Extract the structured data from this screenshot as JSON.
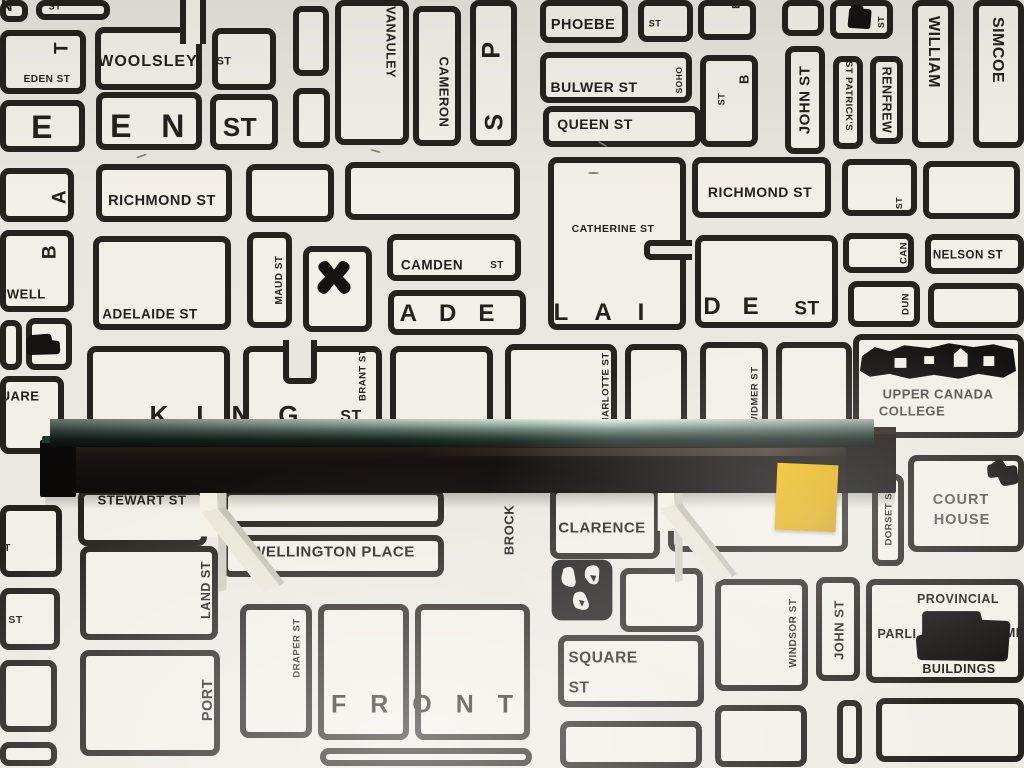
{
  "scene": {
    "wall_color": "#e9e6df",
    "map_ink": "#26221e",
    "map_paper": "#f2efe7"
  },
  "shelf": {
    "glass_color": "#5c7a6c",
    "board_color": "#14100d",
    "bracket_color": "#eee9dd",
    "sticky_note_color": "#e7b214"
  },
  "map": {
    "blocks": [
      [
        0,
        0,
        28,
        22
      ],
      [
        36,
        0,
        74,
        20
      ],
      [
        293,
        6,
        36,
        70
      ],
      [
        293,
        88,
        37,
        60
      ],
      [
        0,
        30,
        86,
        64
      ],
      [
        0,
        100,
        85,
        52
      ],
      [
        95,
        27,
        107,
        63
      ],
      [
        212,
        28,
        64,
        62
      ],
      [
        96,
        92,
        106,
        58
      ],
      [
        210,
        94,
        68,
        56
      ],
      [
        335,
        0,
        74,
        145
      ],
      [
        413,
        6,
        48,
        140
      ],
      [
        470,
        0,
        47,
        146
      ],
      [
        540,
        0,
        88,
        43
      ],
      [
        638,
        0,
        55,
        42
      ],
      [
        540,
        52,
        152,
        51
      ],
      [
        543,
        106,
        158,
        41
      ],
      [
        700,
        55,
        58,
        92
      ],
      [
        698,
        0,
        58,
        40
      ],
      [
        785,
        46,
        40,
        108
      ],
      [
        782,
        0,
        42,
        36
      ],
      [
        830,
        0,
        63,
        39
      ],
      [
        833,
        56,
        30,
        93
      ],
      [
        870,
        56,
        33,
        88
      ],
      [
        912,
        0,
        42,
        148
      ],
      [
        973,
        0,
        51,
        148
      ],
      [
        0,
        168,
        74,
        54
      ],
      [
        0,
        230,
        74,
        82
      ],
      [
        0,
        320,
        22,
        50
      ],
      [
        26,
        318,
        46,
        52
      ],
      [
        0,
        376,
        64,
        78
      ],
      [
        96,
        164,
        136,
        58
      ],
      [
        246,
        164,
        88,
        58
      ],
      [
        345,
        162,
        175,
        58
      ],
      [
        93,
        236,
        138,
        94
      ],
      [
        247,
        232,
        45,
        96
      ],
      [
        303,
        246,
        69,
        86
      ],
      [
        387,
        234,
        134,
        47
      ],
      [
        388,
        290,
        138,
        45
      ],
      [
        548,
        157,
        138,
        173
      ],
      [
        692,
        157,
        139,
        61
      ],
      [
        695,
        235,
        143,
        93
      ],
      [
        842,
        159,
        75,
        57
      ],
      [
        843,
        233,
        71,
        40
      ],
      [
        848,
        281,
        72,
        46
      ],
      [
        923,
        161,
        97,
        58
      ],
      [
        925,
        234,
        99,
        40
      ],
      [
        928,
        283,
        96,
        45
      ],
      [
        87,
        346,
        143,
        97
      ],
      [
        243,
        346,
        139,
        96
      ],
      [
        390,
        346,
        103,
        96
      ],
      [
        505,
        344,
        112,
        94
      ],
      [
        625,
        344,
        62,
        92
      ],
      [
        700,
        342,
        68,
        94
      ],
      [
        776,
        342,
        76,
        94
      ],
      [
        853,
        334,
        171,
        104
      ],
      [
        78,
        489,
        129,
        57
      ],
      [
        222,
        489,
        222,
        38
      ],
      [
        222,
        535,
        222,
        42
      ],
      [
        550,
        487,
        110,
        72
      ],
      [
        668,
        480,
        180,
        72
      ],
      [
        872,
        474,
        32,
        92
      ],
      [
        908,
        455,
        116,
        97
      ],
      [
        620,
        568,
        83,
        64
      ],
      [
        558,
        635,
        146,
        72
      ],
      [
        560,
        721,
        142,
        47
      ],
      [
        715,
        579,
        93,
        112
      ],
      [
        816,
        577,
        44,
        104
      ],
      [
        866,
        579,
        158,
        104
      ],
      [
        837,
        700,
        25,
        64
      ],
      [
        876,
        698,
        148,
        64
      ],
      [
        80,
        546,
        138,
        94
      ],
      [
        80,
        650,
        140,
        106
      ],
      [
        240,
        604,
        72,
        134
      ],
      [
        318,
        604,
        91,
        136
      ],
      [
        415,
        604,
        115,
        136
      ],
      [
        320,
        748,
        212,
        18
      ],
      [
        0,
        505,
        62,
        72
      ],
      [
        0,
        588,
        60,
        62
      ],
      [
        0,
        660,
        57,
        72
      ],
      [
        0,
        742,
        57,
        24
      ],
      [
        715,
        705,
        92,
        62
      ]
    ],
    "cuts": [
      {
        "x": 283,
        "y": 340,
        "w": 34,
        "h": 44,
        "open": "top"
      },
      {
        "x": 180,
        "y": 0,
        "w": 26,
        "h": 44,
        "open": "vert"
      },
      {
        "x": 644,
        "y": 240,
        "w": 48,
        "h": 20,
        "open": "right"
      }
    ],
    "labels": [
      {
        "t": "N",
        "x": 7,
        "y": 7,
        "s": 16,
        "r": "h"
      },
      {
        "t": "ST",
        "x": 55,
        "y": 7,
        "s": 9,
        "r": "h"
      },
      {
        "t": "T",
        "x": 62,
        "y": 48,
        "s": 19,
        "r": "up"
      },
      {
        "t": "EDEN ST",
        "x": 47,
        "y": 80,
        "s": 10,
        "r": "h"
      },
      {
        "t": "WOOLSLEY",
        "x": 148,
        "y": 62,
        "s": 16,
        "r": "h",
        "ls": 1
      },
      {
        "t": "ST",
        "x": 224,
        "y": 62,
        "s": 11,
        "r": "h"
      },
      {
        "t": "E",
        "x": 42,
        "y": 127,
        "s": 32,
        "r": "h"
      },
      {
        "t": "E",
        "x": 121,
        "y": 126,
        "s": 32,
        "r": "h"
      },
      {
        "t": "N",
        "x": 173,
        "y": 126,
        "s": 32,
        "r": "h"
      },
      {
        "t": "ST",
        "x": 240,
        "y": 127,
        "s": 26,
        "r": "h"
      },
      {
        "t": "A",
        "x": 60,
        "y": 197,
        "s": 19,
        "r": "up"
      },
      {
        "t": "B",
        "x": 50,
        "y": 252,
        "s": 19,
        "r": "up"
      },
      {
        "t": "OWELL",
        "x": 21,
        "y": 294,
        "s": 13,
        "r": "h"
      },
      {
        "t": "UARE",
        "x": 20,
        "y": 396,
        "s": 13,
        "r": "h"
      },
      {
        "t": "VANAULEY",
        "x": 390,
        "y": 42,
        "s": 12.5,
        "r": "down"
      },
      {
        "t": "CAMERON",
        "x": 444,
        "y": 92,
        "s": 13,
        "r": "down"
      },
      {
        "t": "P",
        "x": 492,
        "y": 50,
        "s": 25,
        "r": "up"
      },
      {
        "t": "S",
        "x": 495,
        "y": 122,
        "s": 25,
        "r": "up"
      },
      {
        "t": "PHOEBE",
        "x": 583,
        "y": 25,
        "s": 14.5,
        "r": "h"
      },
      {
        "t": "ST",
        "x": 655,
        "y": 24,
        "s": 9,
        "r": "h"
      },
      {
        "t": "BULWER ST",
        "x": 594,
        "y": 87,
        "s": 14,
        "r": "h"
      },
      {
        "t": "SOHO",
        "x": 679,
        "y": 80,
        "s": 8.5,
        "r": "up"
      },
      {
        "t": "QUEEN ST",
        "x": 595,
        "y": 124,
        "s": 14,
        "r": "h"
      },
      {
        "t": "ST",
        "x": 722,
        "y": 99,
        "s": 9,
        "r": "up"
      },
      {
        "t": "B",
        "x": 744,
        "y": 79,
        "s": 13,
        "r": "up"
      },
      {
        "t": "E",
        "x": 737,
        "y": 5,
        "s": 11,
        "r": "up"
      },
      {
        "t": "JOHN ST",
        "x": 805,
        "y": 100,
        "s": 15,
        "r": "up"
      },
      {
        "t": "ST PATRICK'S",
        "x": 848,
        "y": 96,
        "s": 9.5,
        "r": "down"
      },
      {
        "t": "RENFREW",
        "x": 886,
        "y": 100,
        "s": 12.5,
        "r": "down"
      },
      {
        "t": "ST",
        "x": 881,
        "y": 22,
        "s": 8.5,
        "r": "up"
      },
      {
        "t": "WILLIAM",
        "x": 933,
        "y": 52,
        "s": 16,
        "r": "down"
      },
      {
        "t": "SIMCOE",
        "x": 997,
        "y": 50,
        "s": 16,
        "r": "down"
      },
      {
        "t": "RICHMOND ST",
        "x": 162,
        "y": 201,
        "s": 14.5,
        "r": "h"
      },
      {
        "t": "ADELAIDE ST",
        "x": 150,
        "y": 314,
        "s": 13.5,
        "r": "h"
      },
      {
        "t": "MAUD ST",
        "x": 280,
        "y": 280,
        "s": 10,
        "r": "up"
      },
      {
        "t": "CAMDEN",
        "x": 432,
        "y": 265,
        "s": 13.5,
        "r": "h"
      },
      {
        "t": "ST",
        "x": 497,
        "y": 266,
        "s": 10,
        "r": "h"
      },
      {
        "t": "ADE",
        "x": 458,
        "y": 314,
        "s": 24,
        "r": "h",
        "ls": 22
      },
      {
        "t": "CATHERINE ST",
        "x": 613,
        "y": 229,
        "s": 10.5,
        "r": "h"
      },
      {
        "t": "LAI",
        "x": 612,
        "y": 313,
        "s": 24,
        "r": "h",
        "ls": 26
      },
      {
        "t": "RICHMOND ST",
        "x": 760,
        "y": 192,
        "s": 14,
        "r": "h"
      },
      {
        "t": "ST",
        "x": 899,
        "y": 203,
        "s": 8.5,
        "r": "up"
      },
      {
        "t": "CAN",
        "x": 904,
        "y": 253,
        "s": 9.5,
        "r": "up"
      },
      {
        "t": "DUN",
        "x": 906,
        "y": 304,
        "s": 9.5,
        "r": "up"
      },
      {
        "t": "NELSON ST",
        "x": 968,
        "y": 256,
        "s": 11.5,
        "r": "h"
      },
      {
        "t": "DE",
        "x": 742,
        "y": 307,
        "s": 24,
        "r": "h",
        "ls": 22
      },
      {
        "t": "ST",
        "x": 807,
        "y": 309,
        "s": 19,
        "r": "h"
      },
      {
        "t": "KING",
        "x": 238,
        "y": 415,
        "s": 26,
        "r": "h",
        "ls": 28
      },
      {
        "t": "ST",
        "x": 351,
        "y": 417,
        "s": 16,
        "r": "h"
      },
      {
        "t": "BRANT ST",
        "x": 363,
        "y": 375,
        "s": 9.5,
        "r": "up"
      },
      {
        "t": "CHARLOTTE ST",
        "x": 606,
        "y": 392,
        "s": 9.5,
        "r": "up"
      },
      {
        "t": "WIDMER ST",
        "x": 755,
        "y": 396,
        "s": 9.5,
        "r": "up"
      },
      {
        "t": "UPPER CANADA",
        "x": 938,
        "y": 394,
        "s": 13,
        "r": "h",
        "c": "gray"
      },
      {
        "t": "COLLEGE",
        "x": 912,
        "y": 411,
        "s": 13,
        "r": "h",
        "c": "gray"
      },
      {
        "t": "STEWART ST",
        "x": 142,
        "y": 500,
        "s": 13,
        "r": "h"
      },
      {
        "t": "MERCER ST",
        "x": 748,
        "y": 489,
        "s": 10,
        "r": "h"
      },
      {
        "t": "DORSET ST",
        "x": 889,
        "y": 516,
        "s": 9.5,
        "r": "up"
      },
      {
        "t": "COURT",
        "x": 961,
        "y": 500,
        "s": 14.5,
        "r": "h",
        "c": "gray",
        "ls": 1
      },
      {
        "t": "HOUSE",
        "x": 962,
        "y": 520,
        "s": 14.5,
        "r": "h",
        "c": "gray",
        "ls": 1
      },
      {
        "t": "CLARENCE",
        "x": 602,
        "y": 528,
        "s": 15,
        "r": "h"
      },
      {
        "t": "WELLINGTON PLACE",
        "x": 333,
        "y": 552,
        "s": 15,
        "r": "h"
      },
      {
        "t": "BROCK",
        "x": 509,
        "y": 530,
        "s": 13,
        "r": "up"
      },
      {
        "t": "ST",
        "x": 4,
        "y": 549,
        "s": 10,
        "r": "h"
      },
      {
        "t": "A ST",
        "x": 10,
        "y": 620,
        "s": 10.5,
        "r": "h"
      },
      {
        "t": "LAND ST",
        "x": 206,
        "y": 590,
        "s": 12.5,
        "r": "up"
      },
      {
        "t": "PORT",
        "x": 208,
        "y": 700,
        "s": 14.5,
        "r": "up"
      },
      {
        "t": "DRAPER ST",
        "x": 297,
        "y": 648,
        "s": 9.5,
        "r": "up"
      },
      {
        "t": "WINDSOR ST",
        "x": 794,
        "y": 633,
        "s": 10,
        "r": "up"
      },
      {
        "t": "JOHN ST",
        "x": 839,
        "y": 630,
        "s": 13,
        "r": "up"
      },
      {
        "t": "SQUARE",
        "x": 603,
        "y": 658,
        "s": 15.5,
        "r": "h"
      },
      {
        "t": "ST",
        "x": 579,
        "y": 688,
        "s": 15.5,
        "r": "h"
      },
      {
        "t": "PROVINCIAL",
        "x": 958,
        "y": 599,
        "s": 12.5,
        "r": "h"
      },
      {
        "t": "PARLI",
        "x": 897,
        "y": 634,
        "s": 12.5,
        "r": "h"
      },
      {
        "t": "AME",
        "x": 1010,
        "y": 633,
        "s": 12.5,
        "r": "h"
      },
      {
        "t": "BUILDINGS",
        "x": 959,
        "y": 669,
        "s": 12.5,
        "r": "h"
      },
      {
        "t": "FRONT",
        "x": 434,
        "y": 705,
        "s": 25,
        "r": "h",
        "ls": 24
      }
    ],
    "icons": [
      {
        "k": "truck",
        "name": "truck-icon",
        "x": 25,
        "y": 328,
        "w": 40,
        "h": 30
      },
      {
        "k": "splat",
        "name": "splat-icon",
        "x": 314,
        "y": 258,
        "w": 40,
        "h": 44
      },
      {
        "k": "church",
        "name": "building-blob-icon",
        "x": 841,
        "y": 4,
        "w": 34,
        "h": 32
      },
      {
        "k": "ucc",
        "name": "campus-building-icon",
        "x": 860,
        "y": 341,
        "w": 158,
        "h": 40
      },
      {
        "k": "court",
        "name": "courthouse-icon",
        "x": 984,
        "y": 453,
        "w": 40,
        "h": 52
      },
      {
        "k": "face",
        "name": "face-icon",
        "x": 551,
        "y": 558,
        "w": 62,
        "h": 64
      },
      {
        "k": "parl",
        "name": "parliament-building-icon",
        "x": 916,
        "y": 606,
        "w": 98,
        "h": 58
      }
    ],
    "marks": [
      {
        "x": 136,
        "y": 155,
        "r": -20
      },
      {
        "x": 370,
        "y": 150,
        "r": 15
      },
      {
        "x": 588,
        "y": 172,
        "r": 0
      },
      {
        "x": 597,
        "y": 143,
        "r": 30
      }
    ]
  }
}
